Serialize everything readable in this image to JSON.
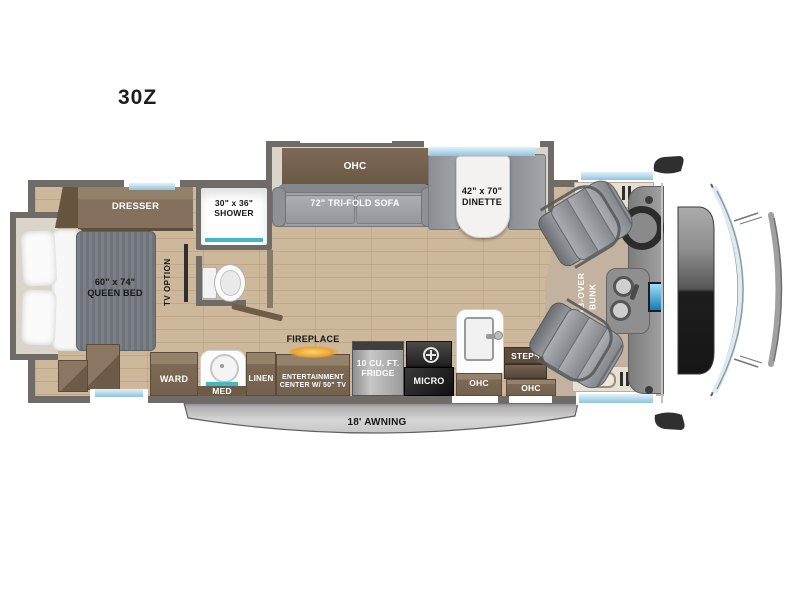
{
  "model": "30Z",
  "colors": {
    "wall": "#6f6b66",
    "floor_wood": "#cdb89b",
    "floor_cab": "#c4b2a0",
    "slide_interior": "#dad4ca",
    "cabinet_brown": "#7d6a55",
    "cabinet_dark": "#5f4e3d",
    "upholstery_gray": "#9da0a4",
    "mattress_gray": "#74787f",
    "table_white": "#f3f2f0",
    "window_blue": "#9cc9e0",
    "accent_teal": "#3fb9c6",
    "fireplace_glow": "#eca22f",
    "awning_gray": "#b9b9b9",
    "hood_dark": "#1d1d1d"
  },
  "rooms": {
    "bedroom": {
      "dresser": "DRESSER",
      "bed": "60\" x 74\"\nQUEEN BED",
      "tv": "TV OPTION",
      "ward": "WARD"
    },
    "bathroom": {
      "shower": "30\" x 36\"\nSHOWER",
      "med": "MED",
      "linen": "LINEN"
    },
    "living": {
      "ohc": "OHC",
      "sofa": "72\" TRI-FOLD SOFA",
      "dinette": "42\" x 70\"\nDINETTE",
      "fireplace": "FIREPLACE",
      "entertainment": "ENTERTAINMENT\nCENTER W/ 50\" TV"
    },
    "kitchen": {
      "fridge": "10 CU. FT.\nFRIDGE",
      "micro": "MICRO",
      "ohc": "OHC"
    },
    "entry": {
      "steps": "STEPS",
      "ohc": "OHC"
    },
    "cab": {
      "bunk": "CAB-OVER\nBUNK"
    },
    "exterior": {
      "awning": "18' AWNING"
    }
  }
}
